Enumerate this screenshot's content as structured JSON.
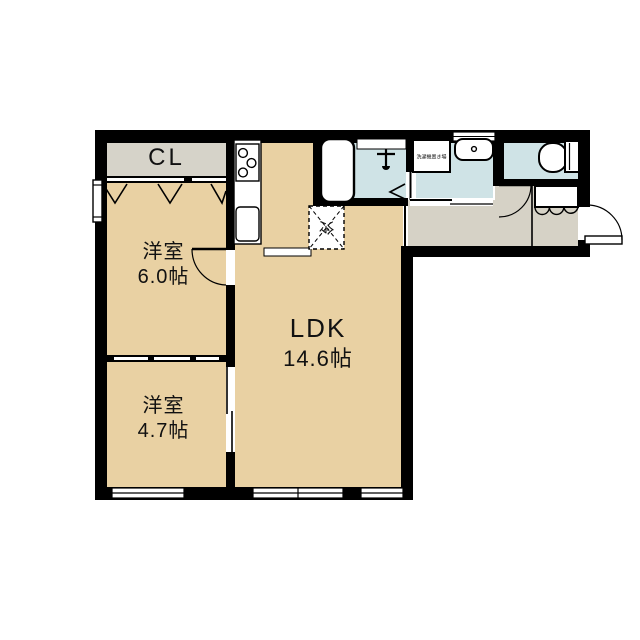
{
  "floorplan": {
    "rooms": {
      "closet": {
        "label": "CL"
      },
      "bedroom1": {
        "name": "洋室",
        "size": "6.0帖"
      },
      "bedroom2": {
        "name": "洋室",
        "size": "4.7帖"
      },
      "ldk": {
        "name": "LDK",
        "size": "14.6帖"
      },
      "refrigerator": {
        "label": "冷"
      },
      "washing_machine": {
        "label": "洗濯機置き場"
      }
    },
    "colors": {
      "wall": "#000000",
      "floor_room": "#e9d1a3",
      "floor_closet": "#d6d3c9",
      "floor_hall": "#d6d2c6",
      "floor_wet": "#cfe3e6",
      "background": "#ffffff"
    }
  }
}
